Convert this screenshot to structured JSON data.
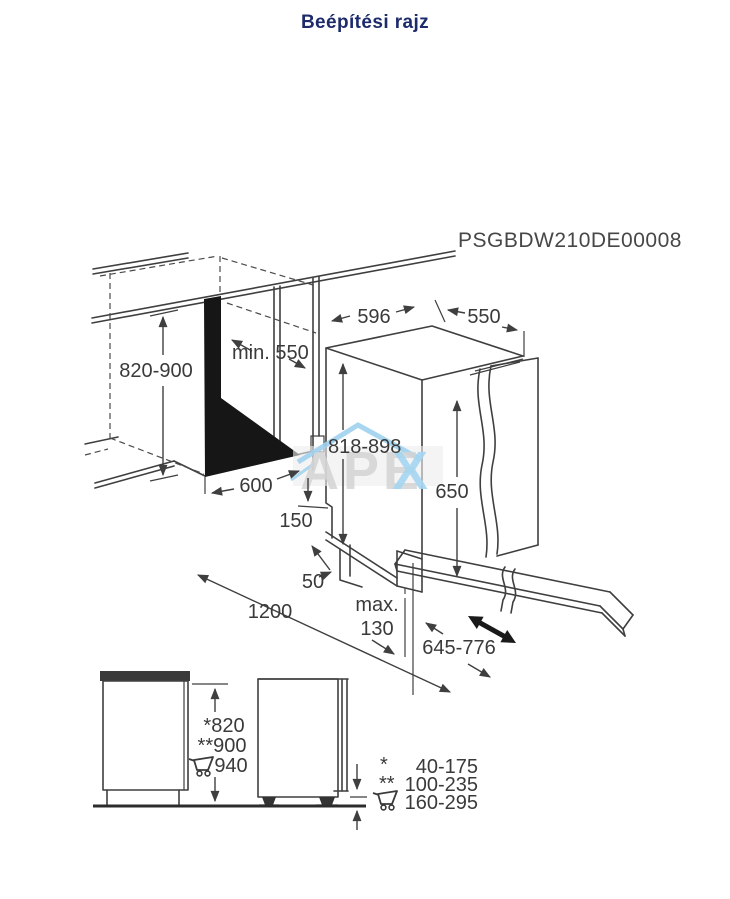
{
  "title": "Beépítési rajz",
  "drawing": {
    "product_code": "PSGBDW210DE00008",
    "dims": {
      "niche_height": "820-900",
      "niche_depth": "min. 550",
      "niche_width": "600",
      "appliance_width": "596",
      "appliance_depth": "550",
      "appliance_height": "818-898",
      "door_panel_height": "650",
      "plinth_height": "150",
      "plinth_recess": "50",
      "front_clearance": "1200",
      "plinth_max_label": "max.",
      "plinth_max_value": "130",
      "door_open_reach": "645-776"
    },
    "watermark": {
      "gray_text": "APE",
      "blue_text": "X"
    }
  },
  "side_views": {
    "height_marks": [
      "*820",
      "**900",
      "940"
    ]
  },
  "legend": {
    "rows": [
      {
        "symbol": "*",
        "range": "40-175"
      },
      {
        "symbol": "**",
        "range": "100-235"
      },
      {
        "symbol": "cart-icon",
        "range": "160-295"
      }
    ]
  },
  "colors": {
    "line": "#3f3f3f",
    "title": "#1d2b6b",
    "watermark_blue": "#a5d6f2"
  }
}
